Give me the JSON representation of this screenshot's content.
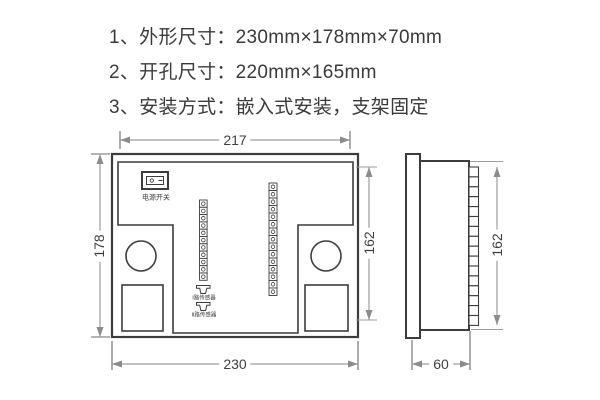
{
  "notes": [
    "1、外形尺寸：230mm×178mm×70mm",
    "2、开孔尺寸：220mm×165mm",
    "3、安装方式：嵌入式安装，支架固定"
  ],
  "front_view": {
    "dim_width_top": "217",
    "dim_height_left": "178",
    "dim_height_right": "162",
    "dim_width_bottom": "230",
    "power_switch_label": "电源开关",
    "sensor_labels": [
      "Ⅰ路传感器",
      "Ⅱ路传感器"
    ],
    "terminal_strips": {
      "left_count": 11,
      "right_count": 15
    }
  },
  "side_view": {
    "dim_height_right": "162",
    "dim_depth_bottom": "60",
    "ladder_count": 16
  },
  "colors": {
    "outline": "#3c3c3c",
    "dimension_line": "#9e9e9e",
    "tick": "#6a6a6a",
    "arrow": "#8c8c8c",
    "text": "#3a3a3a",
    "background": "#ffffff"
  }
}
